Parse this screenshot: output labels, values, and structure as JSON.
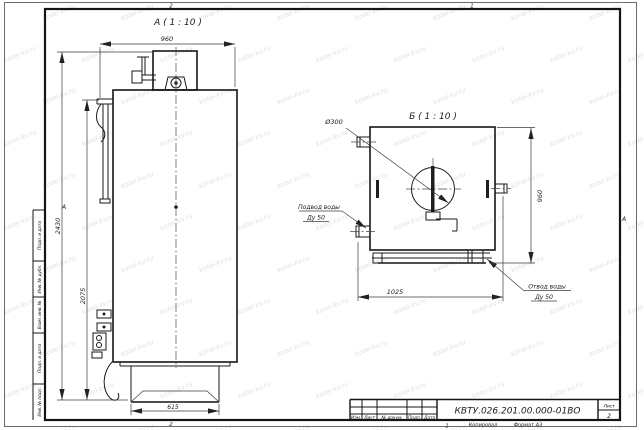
{
  "sheet": {
    "watermark": "kotel-kv.ru",
    "zones": {
      "top_left": "2",
      "top_right": "1",
      "bottom_left": "2",
      "bottom_right": "1",
      "left": "А",
      "right": "А"
    },
    "margin_cells": [
      "Подп. и дата",
      "Инв. № дубл.",
      "Взам. инв. №",
      "Подп. и дата",
      "Инв. № подл."
    ],
    "title_block": {
      "doc_number": "КВТУ.026.201.00.000-01ВО",
      "col_izm": "Изм.",
      "col_list": "Лист",
      "col_doc": "№ докум.",
      "col_podp": "Подп.",
      "col_data": "Дата",
      "sheet_label": "Лист",
      "sheet_number": "2",
      "copied": "Копировал",
      "format": "Формат А3"
    }
  },
  "view_a": {
    "label": "А ( 1 : 10 )",
    "dim_depth": "960",
    "dim_height_total": "2430",
    "dim_height_body": "2075",
    "dim_base": "615"
  },
  "view_b": {
    "label": "Б ( 1 : 10 )",
    "dim_height": "960",
    "dim_width": "1025",
    "dim_hole": "Ø300",
    "inlet_label": "Подвод воды",
    "inlet_dn": "Ду 50",
    "outlet_label": "Отвод воды",
    "outlet_dn": "Ду 50"
  }
}
